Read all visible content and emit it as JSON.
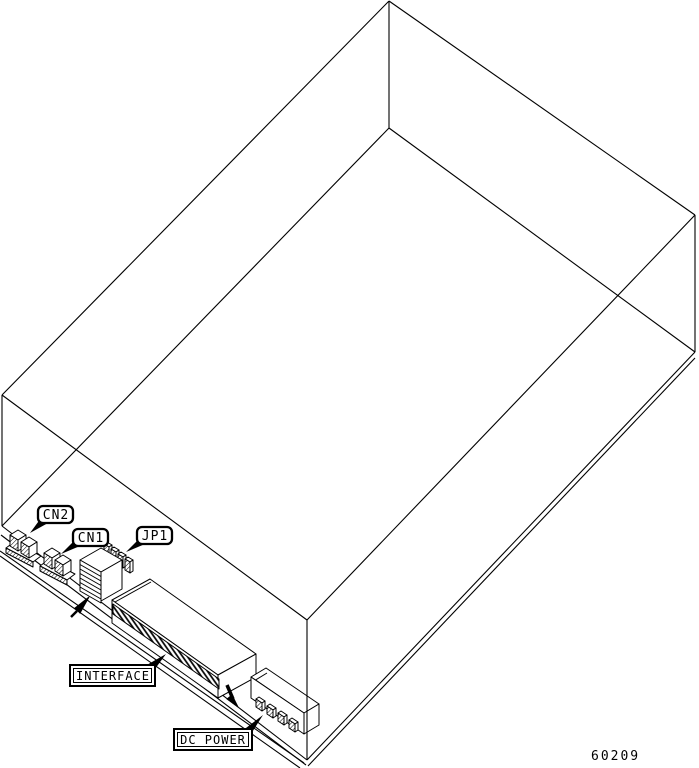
{
  "diagram": {
    "type": "technical-line-drawing",
    "description": "Isometric see-through wireframe of a disk drive enclosure, viewed from the bottom-rear corner, with connector callouts on the rear edge of the board",
    "colors": {
      "line": "#000000",
      "background": "#ffffff"
    },
    "callouts": {
      "cn2": "CN2",
      "cn1": "CN1",
      "jp1": "JP1",
      "interface": "INTERFACE",
      "dc_power": "DC POWER"
    },
    "drawing_number": "60209"
  }
}
